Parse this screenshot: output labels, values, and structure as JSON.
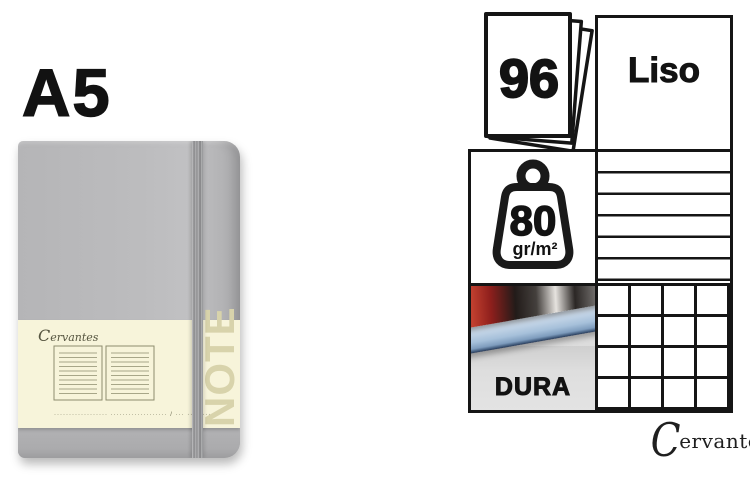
{
  "left": {
    "size_label": "A5",
    "notebook": {
      "brand_script": "Cervantes",
      "note_text": "NOTE",
      "fine_print": "··················  ··················· / ··· ·········"
    }
  },
  "panel": {
    "sheets_count": "96",
    "paper_type_label": "Liso",
    "weight_value": "80",
    "weight_unit": "gr/m²",
    "cover_label": "DURA"
  },
  "footer_brand": {
    "initial": "C",
    "rest": "ervantes",
    "registered": "®",
    "full_name": "Cervantes®"
  },
  "colors": {
    "cover_gray": "#bcbcbe",
    "elastic_gray": "#96969a",
    "band_cream": "#f7f4da",
    "note_khaki": "#d8d3ab",
    "panel_border": "#151515",
    "page_edge_blue": "#a6c0da",
    "photo_red": "#b03a2c"
  },
  "icons": {
    "sheets": "sheet-stack-icon",
    "weight": "weight-icon",
    "lined_paper": "lined-paper-icon",
    "squared_paper": "squared-paper-icon",
    "open_notebook": "open-notebook-illustration"
  }
}
